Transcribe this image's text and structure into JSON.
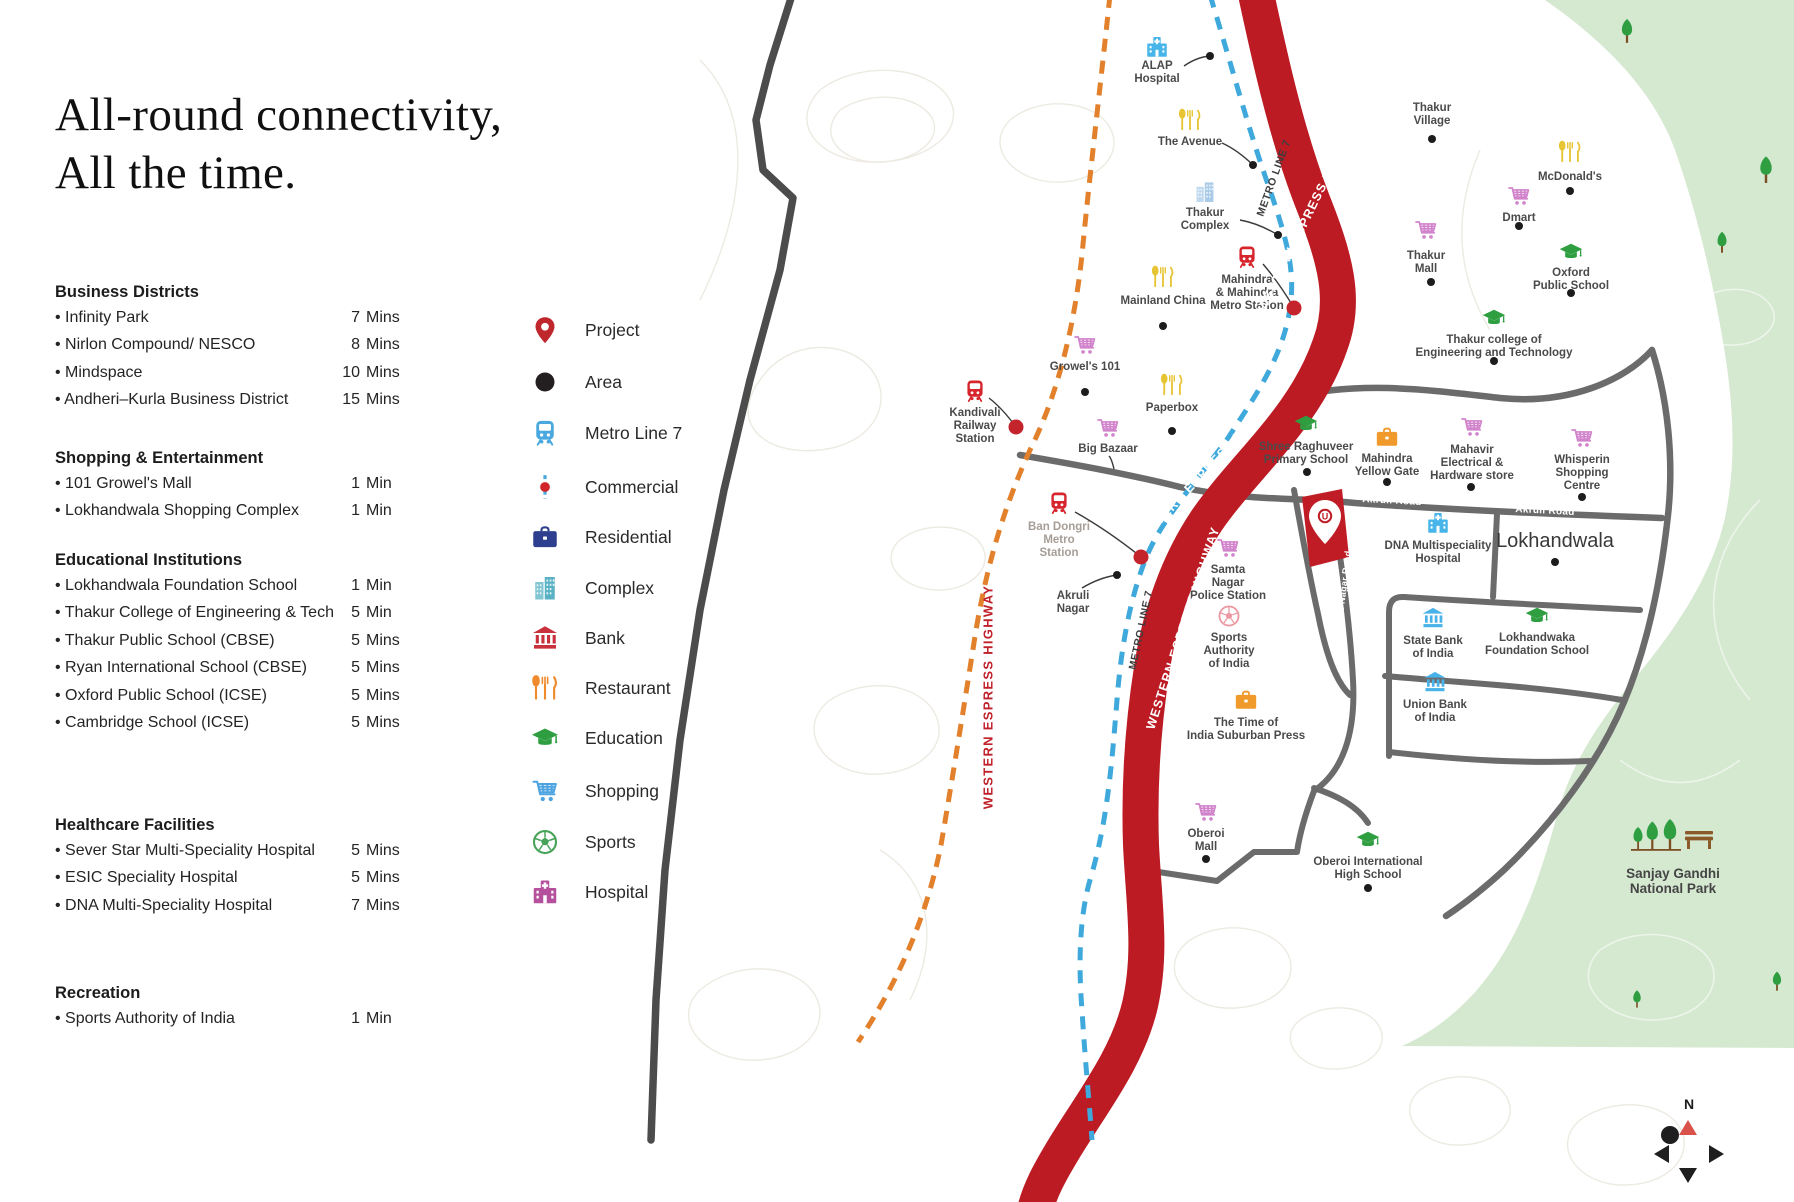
{
  "title": {
    "line1": "All-round connectivity,",
    "line2": "All the time."
  },
  "sidebar": {
    "sections": [
      {
        "heading": "Business Districts",
        "top": 283,
        "items": [
          {
            "name": "Infinity Park",
            "time": "7",
            "unit": "Mins"
          },
          {
            "name": "Nirlon Compound/ NESCO",
            "time": "8",
            "unit": "Mins"
          },
          {
            "name": "Mindspace",
            "time": "10",
            "unit": "Mins"
          },
          {
            "name": "Andheri–Kurla Business District",
            "time": "15",
            "unit": "Mins"
          }
        ]
      },
      {
        "heading": "Shopping & Entertainment",
        "top": 449,
        "items": [
          {
            "name": "101 Growel's Mall",
            "time": "1",
            "unit": "Min"
          },
          {
            "name": "Lokhandwala Shopping Complex",
            "time": "1",
            "unit": "Min"
          }
        ]
      },
      {
        "heading": "Educational Institutions",
        "top": 551,
        "items": [
          {
            "name": "Lokhandwala Foundation School",
            "time": "1",
            "unit": "Min"
          },
          {
            "name": "Thakur College of Engineering & Tech",
            "time": "5",
            "unit": "Min"
          },
          {
            "name": "Thakur Public School (CBSE)",
            "time": "5",
            "unit": "Mins"
          },
          {
            "name": "Ryan International School (CBSE)",
            "time": "5",
            "unit": "Mins"
          },
          {
            "name": "Oxford Public School (ICSE)",
            "time": "5",
            "unit": "Mins"
          },
          {
            "name": "Cambridge School (ICSE)",
            "time": "5",
            "unit": "Mins"
          }
        ]
      },
      {
        "heading": "Healthcare Facilities",
        "top": 816,
        "items": [
          {
            "name": "Sever Star Multi-Speciality Hospital",
            "time": "5",
            "unit": "Mins"
          },
          {
            "name": "ESIC Speciality Hospital",
            "time": "5",
            "unit": "Mins"
          },
          {
            "name": "DNA Multi-Speciality Hospital",
            "time": "7",
            "unit": "Mins"
          }
        ]
      },
      {
        "heading": "Recreation",
        "top": 984,
        "items": [
          {
            "name": "Sports Authority of India",
            "time": "1",
            "unit": "Min"
          }
        ]
      }
    ]
  },
  "legend": {
    "items": [
      {
        "label": "Project",
        "icon": "project-pin-icon",
        "color": "#c0272d",
        "y": 330
      },
      {
        "label": "Area",
        "icon": "area-dot-icon",
        "color": "#231f20",
        "y": 382
      },
      {
        "label": "Metro Line 7",
        "icon": "metro-train-icon",
        "color": "#49a8dd",
        "y": 433
      },
      {
        "label": "Commercial",
        "icon": "commercial-line-icon",
        "color": "#49a8dd",
        "y": 487
      },
      {
        "label": "Residential",
        "icon": "residential-briefcase-icon",
        "color": "#2d3f8e",
        "y": 537
      },
      {
        "label": "Complex",
        "icon": "complex-buildings-icon",
        "color": "#58b2c4",
        "y": 588
      },
      {
        "label": "Bank",
        "icon": "bank-icon",
        "color": "#c8313c",
        "y": 638
      },
      {
        "label": "Restaurant",
        "icon": "restaurant-cutlery-icon",
        "color": "#ef8b2d",
        "y": 688
      },
      {
        "label": "Education",
        "icon": "education-cap-icon",
        "color": "#2f9e41",
        "y": 738
      },
      {
        "label": "Shopping",
        "icon": "shopping-cart-icon",
        "color": "#4da4e0",
        "y": 791
      },
      {
        "label": "Sports",
        "icon": "sports-ball-icon",
        "color": "#48a35a",
        "y": 842
      },
      {
        "label": "Hospital",
        "icon": "hospital-icon",
        "color": "#b5509c",
        "y": 892
      }
    ]
  },
  "map": {
    "compass_n": "N",
    "project_monogram": "U",
    "road_labels": [
      {
        "text": "WESTERN ESPRESS HIGHWAY",
        "x": 1308,
        "y": 215,
        "rot": -64,
        "color": "#ffffff",
        "size": 12.5,
        "ls": 1.1
      },
      {
        "text": "WESTERN ESPRESS HIGHWAY",
        "x": 1208,
        "y": 468,
        "rot": -47,
        "color": "#ffffff",
        "size": 12.5,
        "ls": 1.1
      },
      {
        "text": "WESTERN ESPRESS HIGHWAY",
        "x": 1183,
        "y": 628,
        "rot": -72,
        "color": "#ffffff",
        "size": 12.5,
        "ls": 1.1
      },
      {
        "text": "WESTERN ESPRESS HIGHWAY",
        "x": 988,
        "y": 697,
        "rot": -90,
        "color": "#c0202a",
        "size": 13,
        "ls": 1.3
      },
      {
        "text": "METRO LINE 7",
        "x": 1274,
        "y": 178,
        "rot": -70,
        "color": "#3d3d3d",
        "size": 10.5,
        "ls": 0.6
      },
      {
        "text": "METRO LINE 7",
        "x": 1141,
        "y": 630,
        "rot": -78,
        "color": "#3d3d3d",
        "size": 10.5,
        "ls": 0.6
      },
      {
        "text": "Akruli Road",
        "x": 1392,
        "y": 501,
        "rot": 3,
        "color": "#ffffff",
        "size": 10,
        "ls": 0.3
      },
      {
        "text": "Akruli Road",
        "x": 1545,
        "y": 511,
        "rot": 3,
        "color": "#ffffff",
        "size": 10,
        "ls": 0.3
      },
      {
        "text": "Hanuman Nagar Road",
        "x": 1342,
        "y": 600,
        "rot": -83,
        "color": "#ffffff",
        "size": 9,
        "ls": 0.3
      }
    ],
    "pois": [
      {
        "name": "ALAP Hospital",
        "lines": [
          "ALAP",
          "Hospital"
        ],
        "icon": "hospital-icon",
        "color": "#47b5e9",
        "ix": 1157,
        "iy": 47,
        "ly": 60,
        "dot": [
          1210,
          56
        ],
        "dot_type": "black",
        "conn_from": [
          1184,
          66
        ]
      },
      {
        "name": "The Avenue",
        "lines": [
          "The Avenue"
        ],
        "icon": "restaurant-cutlery-icon",
        "color": "#e7c433",
        "ix": 1190,
        "iy": 120,
        "ly": 136,
        "dot": [
          1253,
          165
        ],
        "dot_type": "black",
        "conn_from": [
          1222,
          143
        ]
      },
      {
        "name": "Thakur Complex",
        "lines": [
          "Thakur",
          "Complex"
        ],
        "icon": "complex-buildings-icon",
        "color": "#a9cbe8",
        "ix": 1205,
        "iy": 192,
        "ly": 207,
        "dot": [
          1278,
          235
        ],
        "dot_type": "black",
        "conn_from": [
          1240,
          220
        ]
      },
      {
        "name": "Thakur Village",
        "lines": [
          "Thakur",
          "Village"
        ],
        "icon": null,
        "lx": 1432,
        "ly": 102,
        "dot": [
          1432,
          139
        ],
        "dot_type": "black"
      },
      {
        "name": "McDonald's",
        "lines": [
          "McDonald's"
        ],
        "icon": "restaurant-cutlery-icon",
        "color": "#e7c433",
        "ix": 1570,
        "iy": 152,
        "ly": 171,
        "dot": [
          1570,
          191
        ],
        "dot_type": "black"
      },
      {
        "name": "Dmart",
        "lines": [
          "Dmart"
        ],
        "icon": "shopping-cart-icon",
        "color": "#d184cc",
        "ix": 1519,
        "iy": 196,
        "ly": 212,
        "dot": [
          1519,
          226
        ],
        "dot_type": "black"
      },
      {
        "name": "Oxford Public School",
        "lines": [
          "Oxford",
          "Public School"
        ],
        "icon": "education-cap-icon",
        "color": "#2f9e41",
        "ix": 1571,
        "iy": 252,
        "ly": 267,
        "dot": [
          1571,
          293
        ],
        "dot_type": "black"
      },
      {
        "name": "Thakur college of Engineering and Technology",
        "lines": [
          "Thakur college of",
          "Engineering and Technology"
        ],
        "icon": "education-cap-icon",
        "color": "#2f9e41",
        "ix": 1494,
        "iy": 318,
        "ly": 334,
        "dot": [
          1494,
          361
        ],
        "dot_type": "black"
      },
      {
        "name": "Mainland China",
        "lines": [
          "Mainland China"
        ],
        "icon": "restaurant-cutlery-icon",
        "color": "#e7c433",
        "ix": 1163,
        "iy": 277,
        "ly": 295,
        "dot": [
          1163,
          326
        ],
        "dot_type": "black"
      },
      {
        "name": "Mahindra & Mahindra Metro Station",
        "lines": [
          "Mahindra",
          "& Mahindra",
          "Metro Station"
        ],
        "icon": "metro-train-icon",
        "color": "#d6252c",
        "ix": 1247,
        "iy": 257,
        "ly": 274,
        "dot": [
          1294,
          308
        ],
        "dot_type": "red",
        "conn_from": [
          1263,
          264
        ]
      },
      {
        "name": "Thakur Mall",
        "lines": [
          "Thakur",
          "Mall"
        ],
        "icon": "shopping-cart-icon",
        "color": "#d184cc",
        "ix": 1426,
        "iy": 230,
        "ly": 250,
        "dot": [
          1431,
          282
        ],
        "dot_type": "black"
      },
      {
        "name": "Growel's 101",
        "lines": [
          "Growel's 101"
        ],
        "icon": "shopping-cart-icon",
        "color": "#d184cc",
        "ix": 1085,
        "iy": 345,
        "ly": 361,
        "dot": [
          1085,
          392
        ],
        "dot_type": "black"
      },
      {
        "name": "Paperbox",
        "lines": [
          "Paperbox"
        ],
        "icon": "restaurant-cutlery-icon",
        "color": "#e7c433",
        "ix": 1172,
        "iy": 385,
        "ly": 402,
        "dot": [
          1172,
          431
        ],
        "dot_type": "black"
      },
      {
        "name": "Big Bazaar",
        "lines": [
          "Big Bazaar"
        ],
        "icon": "shopping-cart-icon",
        "color": "#d184cc",
        "ix": 1108,
        "iy": 428,
        "ly": 443,
        "conn_from": [
          1109,
          456
        ],
        "conn_to": [
          1114,
          469
        ]
      },
      {
        "name": "Kandivali Railway Station",
        "lines": [
          "Kandivali",
          "Railway",
          "Station"
        ],
        "icon": "metro-train-icon",
        "color": "#d6252c",
        "ix": 975,
        "iy": 391,
        "ly": 407,
        "dot": [
          1016,
          427
        ],
        "dot_type": "red",
        "conn_from": [
          989,
          398
        ]
      },
      {
        "name": "Shree Raghuveer Primary School",
        "lines": [
          "Shree Raghuveer",
          "Primary School"
        ],
        "icon": "education-cap-icon",
        "color": "#2f9e41",
        "ix": 1306,
        "iy": 424,
        "ly": 441,
        "dot": [
          1307,
          472
        ],
        "dot_type": "black"
      },
      {
        "name": "Mahindra Yellow Gate",
        "lines": [
          "Mahindra",
          "Yellow Gate"
        ],
        "icon": "residential-briefcase-icon",
        "color": "#f09a2b",
        "ix": 1387,
        "iy": 437,
        "ly": 453,
        "dot": [
          1387,
          482
        ],
        "dot_type": "black"
      },
      {
        "name": "Mahavir Electrical & Hardware store",
        "lines": [
          "Mahavir",
          "Electrical &",
          "Hardware store"
        ],
        "icon": "shopping-cart-icon",
        "color": "#d184cc",
        "ix": 1472,
        "iy": 427,
        "ly": 444,
        "dot": [
          1471,
          487
        ],
        "dot_type": "black"
      },
      {
        "name": "Whisperin Shopping Centre",
        "lines": [
          "Whisperin",
          "Shopping",
          "Centre"
        ],
        "icon": "shopping-cart-icon",
        "color": "#d184cc",
        "ix": 1582,
        "iy": 438,
        "ly": 454,
        "dot": [
          1582,
          497
        ],
        "dot_type": "black"
      },
      {
        "name": "DNA Multispeciality Hospital",
        "lines": [
          "DNA Multispeciality",
          "Hospital"
        ],
        "icon": "hospital-icon",
        "color": "#47b5e9",
        "ix": 1438,
        "iy": 523,
        "ly": 540
      },
      {
        "name": "Lokhandwala",
        "lines": [
          "Lokhandwala"
        ],
        "icon": null,
        "lx": 1555,
        "ly": 530,
        "lsize": 20,
        "lweight": "normal",
        "lcolor": "#383838",
        "dot": [
          1555,
          562
        ],
        "dot_type": "black"
      },
      {
        "name": "Samta Nagar Police Station",
        "lines": [
          "Samta",
          "Nagar",
          "Police Station"
        ],
        "icon": "shopping-cart-icon",
        "color": "#d184cc",
        "ix": 1228,
        "iy": 548,
        "ly": 564
      },
      {
        "name": "Sports Authority of India",
        "lines": [
          "Sports",
          "Authority",
          "of India"
        ],
        "icon": "sports-ball-icon",
        "color": "#eb9aa3",
        "ix": 1229,
        "iy": 616,
        "ly": 632
      },
      {
        "name": "The Time of India Suburban Press",
        "lines": [
          "The Time of",
          "India Suburban Press"
        ],
        "icon": "residential-briefcase-icon",
        "color": "#f09a2b",
        "ix": 1246,
        "iy": 700,
        "ly": 717
      },
      {
        "name": "State Bank of India",
        "lines": [
          "State Bank",
          "of India"
        ],
        "icon": "bank-icon",
        "color": "#49b2e8",
        "ix": 1433,
        "iy": 618,
        "ly": 635
      },
      {
        "name": "Union Bank of India",
        "lines": [
          "Union Bank",
          "of India"
        ],
        "icon": "bank-icon",
        "color": "#49b2e8",
        "ix": 1435,
        "iy": 682,
        "ly": 699
      },
      {
        "name": "Lokhandwaka Foundation School",
        "lines": [
          "Lokhandwaka",
          "Foundation School"
        ],
        "icon": "education-cap-icon",
        "color": "#2f9e41",
        "ix": 1537,
        "iy": 616,
        "ly": 632
      },
      {
        "name": "Oberoi Mall",
        "lines": [
          "Oberoi",
          "Mall"
        ],
        "icon": "shopping-cart-icon",
        "color": "#d184cc",
        "ix": 1206,
        "iy": 812,
        "ly": 828,
        "dot": [
          1206,
          859
        ],
        "dot_type": "black"
      },
      {
        "name": "Oberoi International High School",
        "lines": [
          "Oberoi International",
          "High School"
        ],
        "icon": "education-cap-icon",
        "color": "#2f9e41",
        "ix": 1368,
        "iy": 840,
        "ly": 856,
        "dot": [
          1368,
          888
        ],
        "dot_type": "black"
      },
      {
        "name": "Akruli Nagar",
        "lines": [
          "Akruli",
          "Nagar"
        ],
        "icon": null,
        "lx": 1073,
        "ly": 590,
        "dot": [
          1117,
          575
        ],
        "dot_type": "black",
        "conn_from": [
          1082,
          588
        ]
      },
      {
        "name": "Ban Dongri Metro Station",
        "lines": [
          "Ban Dongri",
          "Metro",
          "Station"
        ],
        "icon": "metro-train-icon",
        "color": "#d6252c",
        "ix": 1059,
        "iy": 503,
        "ly": 521,
        "lcolor": "#a59d96",
        "dot": [
          1141,
          557
        ],
        "dot_type": "red",
        "conn_from": [
          1075,
          512
        ]
      },
      {
        "name": "Sanjay Gandhi National Park",
        "lines": [
          "Sanjay Gandhi",
          "National Park"
        ],
        "icon": "park-trees-icon",
        "ix": 1673,
        "iy": 838,
        "isize": 92,
        "ly": 866,
        "lsize": 13.5,
        "lcolor": "#454545"
      }
    ]
  }
}
